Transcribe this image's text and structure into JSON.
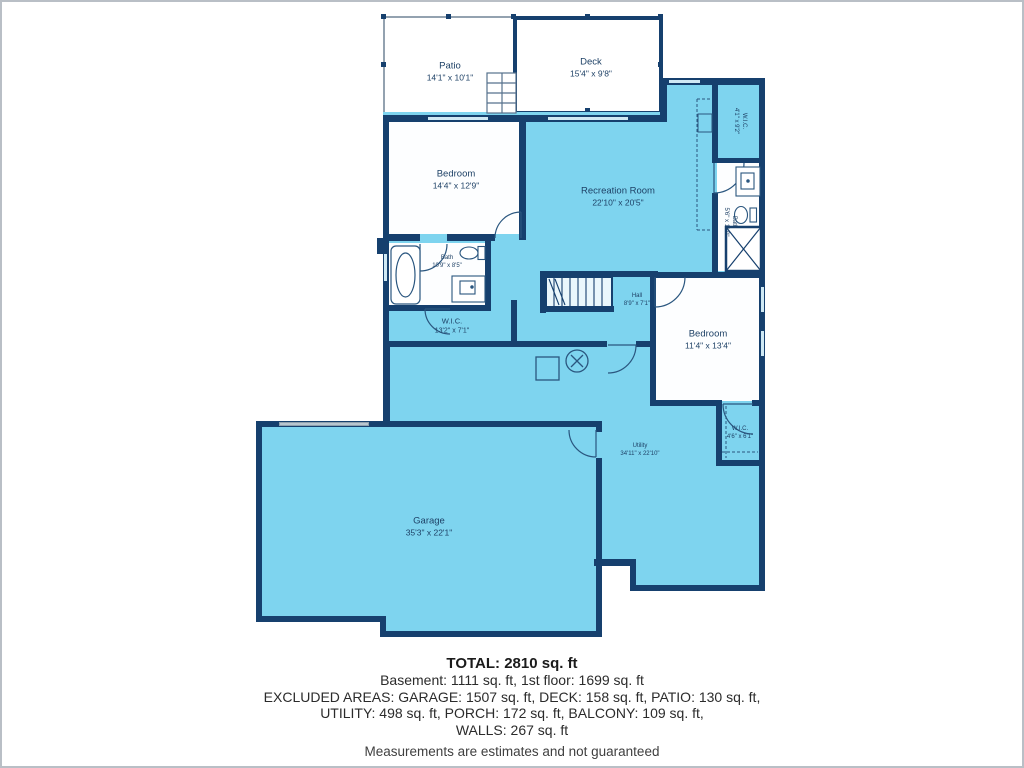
{
  "meta": {
    "wall_color": "#16406e",
    "floor_color": "#7ed4ef",
    "window_color": "#cfe9f4",
    "label_color": "#1e4166"
  },
  "rooms": {
    "patio": {
      "name": "Patio",
      "dims": "14'1\" x 10'1\""
    },
    "deck": {
      "name": "Deck",
      "dims": "15'4\" x 9'8\""
    },
    "bedroom_upper": {
      "name": "Bedroom",
      "dims": "14'4\" x 12'9\""
    },
    "recreation": {
      "name": "Recreation Room",
      "dims": "22'10\" x 20'5\""
    },
    "wic_top": {
      "name": "W.I.C.",
      "dims": "4'1\" x 9'2\""
    },
    "bath_right": {
      "name": "Bath",
      "dims": "5'6\" x 11'0\""
    },
    "bath_mid": {
      "name": "Bath",
      "dims": "10'9\" x 8'5\""
    },
    "wic_mid": {
      "name": "W.I.C.",
      "dims": "13'2\" x 7'1\""
    },
    "hall": {
      "name": "Hall",
      "dims": "8'9\" x 7'1\""
    },
    "bedroom_right": {
      "name": "Bedroom",
      "dims": "11'4\" x 13'4\""
    },
    "wic_lower": {
      "name": "W.I.C.",
      "dims": "4'6\" x 6'1\""
    },
    "utility": {
      "name": "Utility",
      "dims": "34'11\" x 22'10\""
    },
    "garage": {
      "name": "Garage",
      "dims": "35'3\" x 22'1\""
    }
  },
  "summary": {
    "total": "TOTAL: 2810 sq. ft",
    "line2": "Basement: 1111 sq. ft, 1st floor: 1699 sq. ft",
    "line3": "EXCLUDED AREAS: GARAGE: 1507 sq. ft, DECK: 158 sq. ft, PATIO: 130 sq. ft,",
    "line4": "UTILITY: 498 sq. ft, PORCH: 172 sq. ft, BALCONY: 109 sq. ft,",
    "line5": "WALLS: 267 sq. ft",
    "disclaimer": "Measurements are estimates and not guaranteed"
  }
}
